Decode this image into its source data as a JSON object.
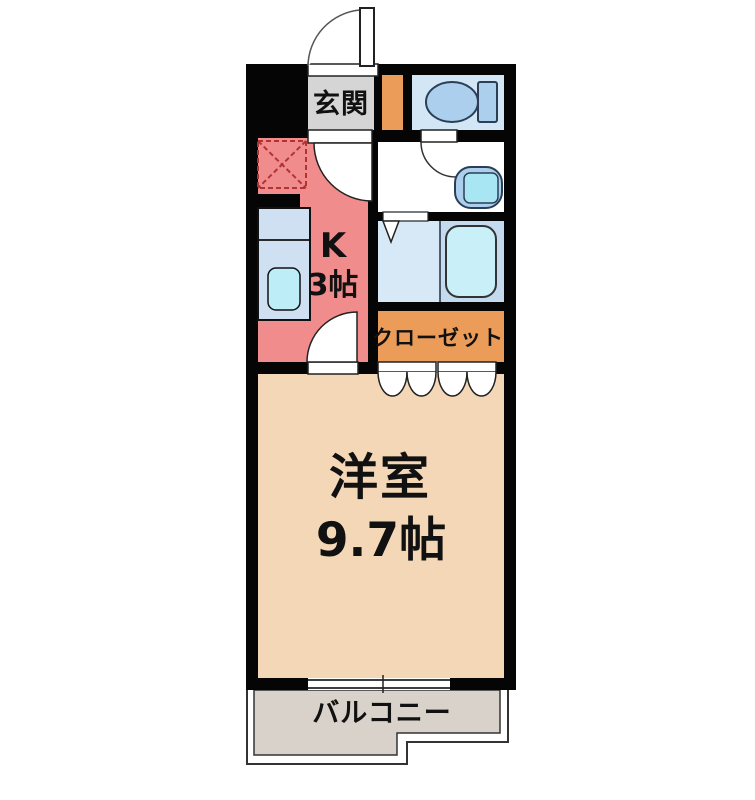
{
  "title": "1K間取り図",
  "labels": {
    "entrance": "玄関",
    "kitchen_type": "K",
    "kitchen_area": "3帖",
    "closet": "クローゼット",
    "main_room": "洋室",
    "main_room_area": "9.7帖",
    "balcony": "バルコニー"
  },
  "rooms": [
    {
      "id": "genkan",
      "label": "玄関",
      "type": "entrance"
    },
    {
      "id": "kitchen",
      "label": "K",
      "area": "3帖"
    },
    {
      "id": "toilet",
      "label": "",
      "type": "toilet"
    },
    {
      "id": "washroom",
      "label": "",
      "type": "washroom"
    },
    {
      "id": "bathroom",
      "label": "",
      "type": "bathroom"
    },
    {
      "id": "closet",
      "label": "クローゼット",
      "type": "storage"
    },
    {
      "id": "western-room",
      "label": "洋室",
      "area": "9.7帖"
    },
    {
      "id": "balcony",
      "label": "バルコニー",
      "type": "outdoor"
    }
  ],
  "fixtures": [
    "toilet-icon",
    "wash-basin-icon",
    "bathtub-icon",
    "kitchen-counter-icon",
    "kitchen-sink-icon",
    "refrigerator-space-icon",
    "entry-door-swing-icon",
    "interior-door-swing-icon",
    "folding-door-icon",
    "sliding-window-icon"
  ],
  "colors": {
    "wall": "#050505",
    "genkan": "#d5d5d5",
    "entrance_storage": "#eb9c58",
    "closet": "#eb9c58",
    "kitchen": "#f18c8c",
    "western_room": "#f4d7b7",
    "balcony": "#d9d2cb",
    "toilet_floor": "#d3e6f5",
    "bathroom_floor": "#d7e8f6",
    "bathtub_zone": "#c3daef",
    "fixture_blue": "#abcfec",
    "tub_blue": "#c9f0f9",
    "sink_blue": "#bdeef7",
    "counter_blue": "#cfe0f2",
    "basin_inner": "#a9e6f3",
    "dashed_red": "#b23333",
    "text": "#111111",
    "line": "#222222"
  }
}
